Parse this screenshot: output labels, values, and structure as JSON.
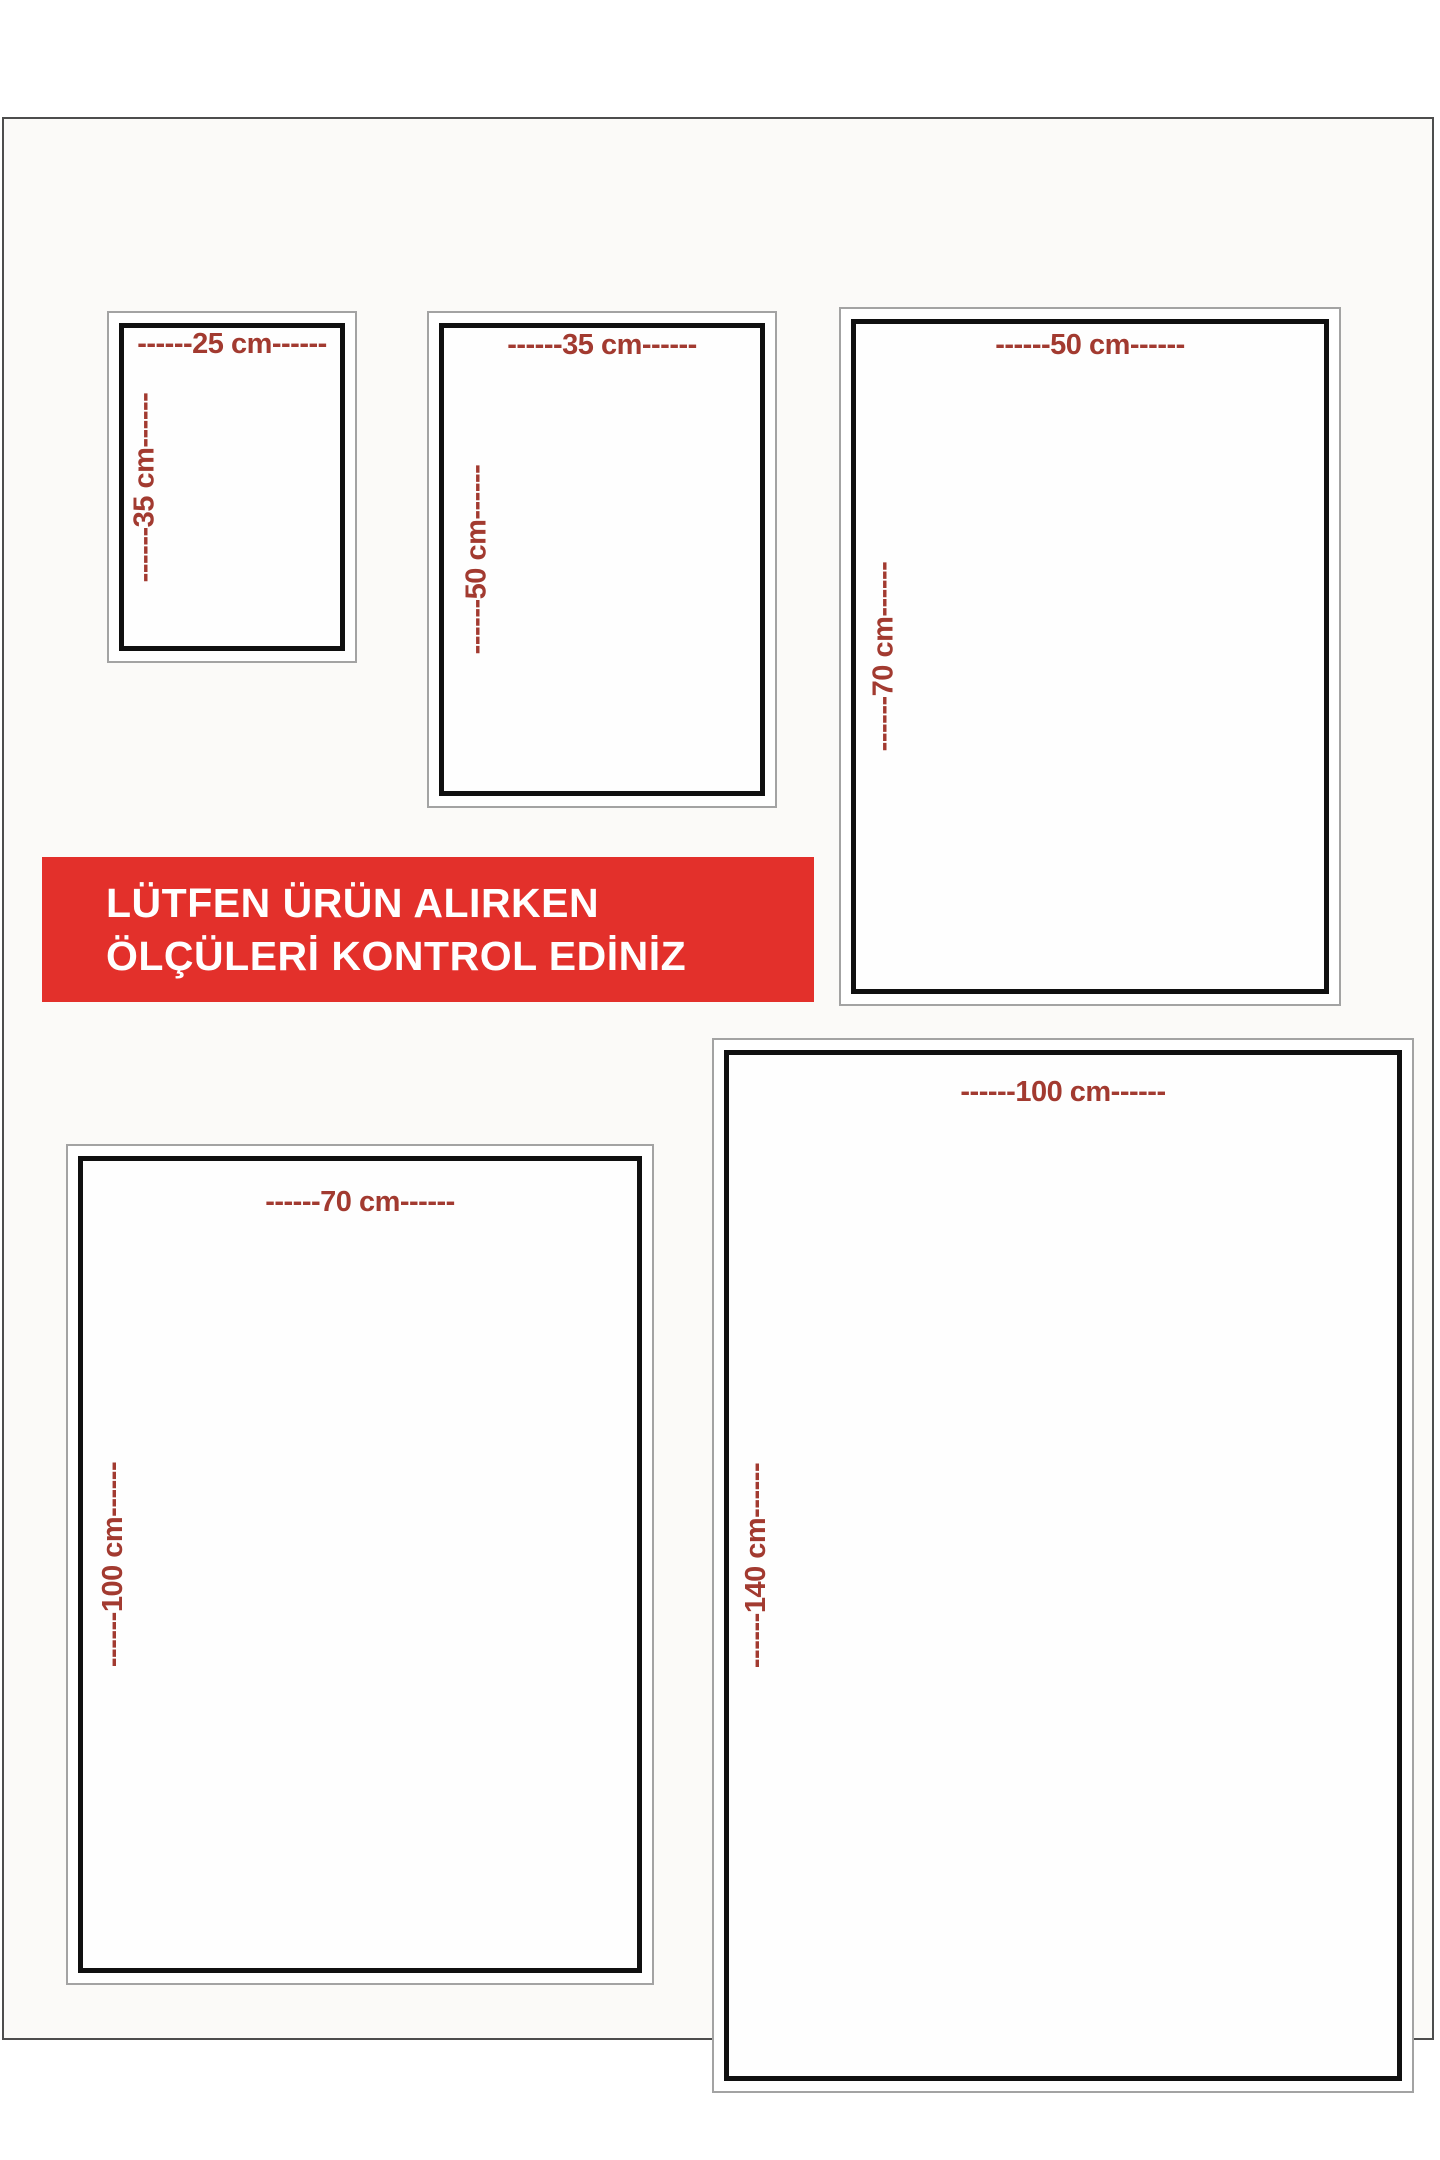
{
  "banner": {
    "line1": "LÜTFEN ÜRÜN ALIRKEN",
    "line2": "ÖLÇÜLERİ KONTROL EDİNİZ"
  },
  "colors": {
    "banner_bg": "#e3302b",
    "banner_text": "#ffffff",
    "dimension_label": "#a23a30",
    "rect_border": "#101010"
  },
  "sizes": [
    {
      "name": "25x35",
      "width_cm": 25,
      "height_cm": 35,
      "top_label": "------25 cm------",
      "side_label": "------35 cm------"
    },
    {
      "name": "35x50",
      "width_cm": 35,
      "height_cm": 50,
      "top_label": "------35 cm------",
      "side_label": "------50 cm------"
    },
    {
      "name": "50x70",
      "width_cm": 50,
      "height_cm": 70,
      "top_label": "------50 cm------",
      "side_label": "------70 cm------"
    },
    {
      "name": "70x100",
      "width_cm": 70,
      "height_cm": 100,
      "top_label": "------70 cm------",
      "side_label": "------100 cm------"
    },
    {
      "name": "100x140",
      "width_cm": 100,
      "height_cm": 140,
      "top_label": "------100 cm------",
      "side_label": "------140 cm------"
    }
  ]
}
